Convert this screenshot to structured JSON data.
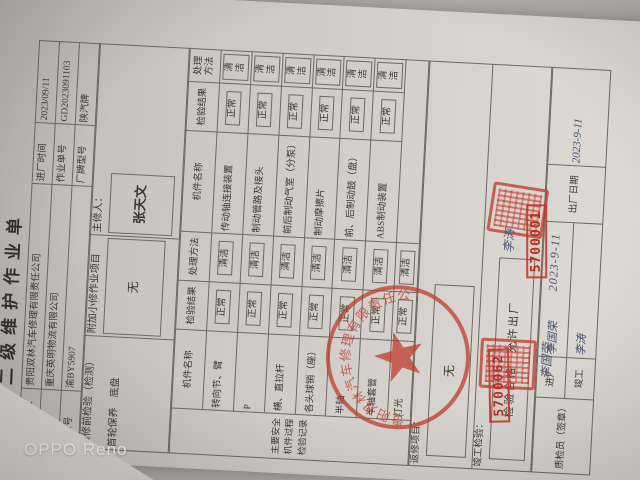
{
  "photo": {
    "watermark": "OPPO Reno"
  },
  "doc": {
    "title": "二级维护作业单",
    "header": {
      "repair_company_label": "维修企业：",
      "repair_company": "贵阳双林汽车修理有限责任公司",
      "entry_time_label": "进厂时间",
      "entry_time": "2023/09/11",
      "client_label": "托修方",
      "client": "重庆英明物流有限公司",
      "order_no_label": "作业单号",
      "order_no": "GD2023091103",
      "plate_label": "牌照号",
      "plate": "渝BY5907",
      "brand_label": "厂牌型号",
      "brand": "陕汽牌"
    },
    "section": {
      "pre_repair_label": "维修前检验（检测）",
      "category": "首轮保养　底盘",
      "additional_label": "附加小修作业项目",
      "additional_value": "无",
      "chief_label": "主修人：",
      "chief": "张天文"
    },
    "side_label": "主要安全机件过程检验记录",
    "table_headers": {
      "name": "机件名称",
      "result": "检验结果",
      "method": "处理方法"
    },
    "left_rows": [
      {
        "name": "转向节、臂",
        "result": "正常",
        "method": "清洁"
      },
      {
        "name": "P",
        "result": "正常",
        "method": "清洁"
      },
      {
        "name": "横、直拉杆",
        "result": "正常",
        "method": "清洁"
      },
      {
        "name": "各头球销（座）",
        "result": "正常",
        "method": "清洁"
      },
      {
        "name": "半轴",
        "result": "正常",
        "method": "清洁"
      },
      {
        "name": "半轴套管",
        "result": "正常",
        "method": "清洁"
      },
      {
        "name": "灯光",
        "result": "正常",
        "method": "清洁"
      }
    ],
    "right_rows": [
      {
        "name": "传动轴连接装置",
        "result": "正常",
        "method": "清洁"
      },
      {
        "name": "制动管路及接头",
        "result": "正常",
        "method": "清洁"
      },
      {
        "name": "前后制动气室（分泵）",
        "result": "正常",
        "method": "清洁"
      },
      {
        "name": "制动摩擦片",
        "result": "正常",
        "method": "清洁"
      },
      {
        "name": "前、后制动鼓（盘）",
        "result": "正常",
        "method": "清洁"
      },
      {
        "name": "ABS制动装置",
        "result": "正常",
        "method": "清洁"
      }
    ],
    "rework": {
      "label": "返修项目：",
      "value": "无"
    },
    "completion": {
      "label": "竣工检验：",
      "value": "检验合格　允许出厂"
    },
    "inspector": {
      "label": "质检员（签章）",
      "entry_label": "进厂",
      "finish_label": "竣工",
      "entry_sign": "李国荣",
      "finish_sign": "李涛",
      "exit_date_label": "出厂日期",
      "exit_date": "2023-9-11"
    },
    "stamps": {
      "round_seal_company": "贵阳双林汽车修理有限责任公司",
      "stamp_no_entry": "5700062",
      "stamp_no_finish": "5700001",
      "color": "#c0392b"
    }
  }
}
